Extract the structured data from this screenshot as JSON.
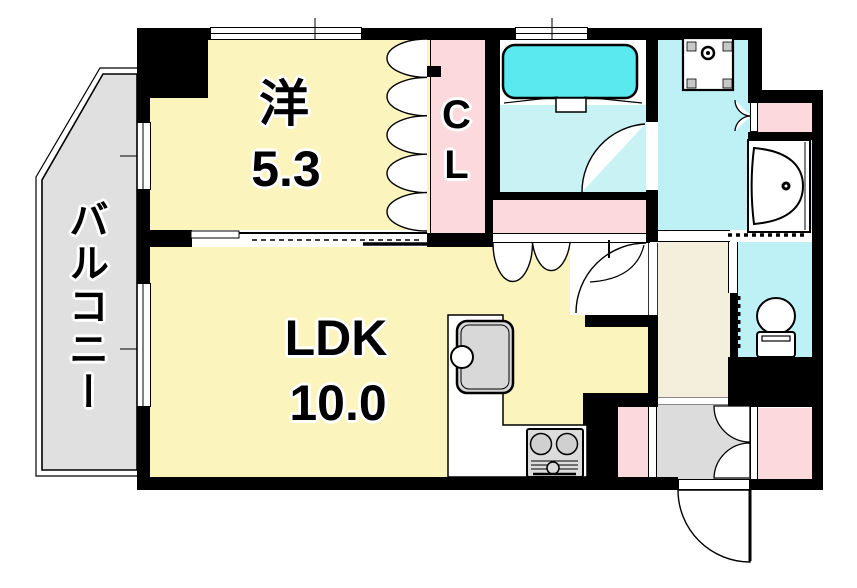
{
  "plan_title": "1LDK apartment floor plan",
  "rooms": {
    "western": {
      "label": "洋",
      "size": "5.3"
    },
    "ldk": {
      "label": "LDK",
      "size": "10.0"
    },
    "closet": {
      "label": "CL"
    },
    "balcony": {
      "label": "バルコニー"
    }
  },
  "colors": {
    "room_yellow": "#FBF5BD",
    "closet_pink": "#FBD9DD",
    "washroom_cyan": "#BEF1F6",
    "bath_floor_cyan": "#C9F2F5",
    "bathtub_cyan": "#59E9EE",
    "balcony_gray": "#E0E0E0",
    "entrance_gray": "#DCDCDC",
    "hallway_beige": "#F4EEDC",
    "counter_tan": "#D8B180",
    "wall_black": "#000000"
  },
  "fixtures": [
    "bathtub",
    "washing-machine-pan",
    "washbasin-vanity",
    "toilet",
    "kitchen-sink",
    "gas-stove",
    "entry-door",
    "bathroom-door",
    "ldk-door",
    "closet-bifold-doors",
    "entrance-storage-doors",
    "sliding-door",
    "windows"
  ]
}
